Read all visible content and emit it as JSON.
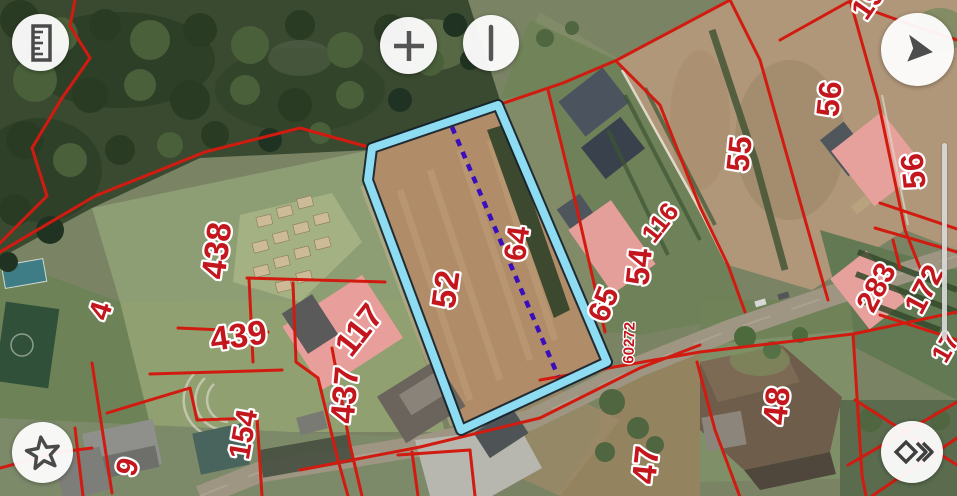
{
  "app": {
    "type": "cadastral-map-viewer"
  },
  "toolbar": {
    "buttons": [
      {
        "id": "measure",
        "icon": "ruler-icon"
      },
      {
        "id": "zoom-in",
        "icon": "plus-icon"
      },
      {
        "id": "zoom-bar",
        "icon": "vertical-bar-icon"
      },
      {
        "id": "navigate",
        "icon": "cursor-arrow-icon"
      },
      {
        "id": "favorites",
        "icon": "star-icon"
      },
      {
        "id": "layers-next",
        "icon": "diamond-chevron-icon"
      }
    ]
  },
  "map": {
    "boundary_color": "#d21b10",
    "label_color": "#c3161d",
    "selected_parcel": {
      "number": "52",
      "outline_color": "#8edcf2",
      "centerline_color": "#3a0dbd"
    },
    "side_scrollbar": {
      "color": "#d9d9d9"
    },
    "labels": [
      {
        "text": "438",
        "x": 228,
        "y": 252,
        "rot": -83,
        "size": 34
      },
      {
        "text": "4",
        "x": 110,
        "y": 314,
        "rot": -72,
        "size": 30
      },
      {
        "text": "439",
        "x": 240,
        "y": 347,
        "rot": -8,
        "size": 34
      },
      {
        "text": "117",
        "x": 368,
        "y": 337,
        "rot": -52,
        "size": 34
      },
      {
        "text": "437",
        "x": 356,
        "y": 396,
        "rot": -85,
        "size": 34
      },
      {
        "text": "154",
        "x": 253,
        "y": 436,
        "rot": -80,
        "size": 30
      },
      {
        "text": "9",
        "x": 137,
        "y": 470,
        "rot": -72,
        "size": 30
      },
      {
        "text": "52",
        "x": 457,
        "y": 291,
        "rot": -82,
        "size": 34
      },
      {
        "text": "64",
        "x": 527,
        "y": 245,
        "rot": -82,
        "size": 31
      },
      {
        "text": "65",
        "x": 613,
        "y": 308,
        "rot": -68,
        "size": 31
      },
      {
        "text": "54",
        "x": 650,
        "y": 268,
        "rot": -84,
        "size": 33
      },
      {
        "text": "116",
        "x": 667,
        "y": 228,
        "rot": -52,
        "size": 26
      },
      {
        "text": "60272",
        "x": 634,
        "y": 343,
        "rot": -88,
        "size": 15
      },
      {
        "text": "55",
        "x": 750,
        "y": 155,
        "rot": -84,
        "size": 32
      },
      {
        "text": "56",
        "x": 840,
        "y": 100,
        "rot": -84,
        "size": 32
      },
      {
        "text": "56",
        "x": 924,
        "y": 170,
        "rot": -96,
        "size": 32
      },
      {
        "text": "283",
        "x": 885,
        "y": 292,
        "rot": -62,
        "size": 30
      },
      {
        "text": "172",
        "x": 933,
        "y": 294,
        "rot": -62,
        "size": 30
      },
      {
        "text": "48",
        "x": 788,
        "y": 407,
        "rot": -84,
        "size": 34
      },
      {
        "text": "47",
        "x": 657,
        "y": 466,
        "rot": -84,
        "size": 34
      },
      {
        "text": "19",
        "x": 876,
        "y": 8,
        "rot": -55,
        "size": 30
      },
      {
        "text": "17",
        "x": 953,
        "y": 352,
        "rot": -60,
        "size": 26
      }
    ]
  }
}
